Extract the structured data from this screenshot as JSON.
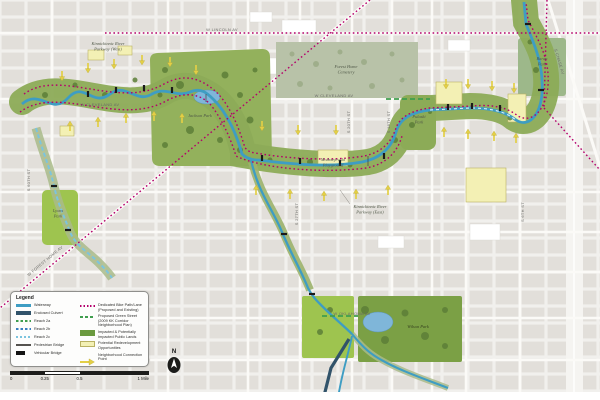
{
  "map": {
    "street_labels": [
      {
        "text": "W LINCOLN AV"
      },
      {
        "text": "W CLEVELAND AV"
      },
      {
        "text": "W CLEVELAND AV"
      },
      {
        "text": "W OKLAHOMA AV"
      },
      {
        "text": "W FOREST HOME AV"
      },
      {
        "text": "S CHASE AV"
      },
      {
        "text": "S 20TH ST"
      },
      {
        "text": "S 16TH ST"
      },
      {
        "text": "S 27TH ST"
      },
      {
        "text": "S 60TH ST"
      },
      {
        "text": "S 6TH ST"
      }
    ],
    "area_labels": [
      {
        "lines": [
          "Kinnickinnic River",
          "Parkway (West)"
        ]
      },
      {
        "lines": [
          "Jackson Park"
        ]
      },
      {
        "lines": [
          "Forest Home",
          "Cemetery"
        ]
      },
      {
        "lines": [
          "Kinnickinnic River",
          "Parkway (East)"
        ]
      },
      {
        "lines": [
          "Wilson Park"
        ]
      },
      {
        "lines": [
          "Lyons",
          "Park"
        ]
      },
      {
        "lines": [
          "Baran",
          "Park"
        ]
      },
      {
        "lines": [
          "Pulaski",
          "Park"
        ]
      },
      {
        "lines": [
          "Modrzejewski",
          "Playground"
        ]
      }
    ]
  },
  "legend": {
    "title": "Legend",
    "left_items": [
      {
        "label": "Waterway"
      },
      {
        "label": "Enclosed Culvert"
      },
      {
        "label": "Reach 2a"
      },
      {
        "label": "Reach 2b"
      },
      {
        "label": "Reach 2c"
      },
      {
        "label": "Pedestrian Bridge"
      },
      {
        "label": "Vehicular Bridge"
      }
    ],
    "right_items": [
      {
        "label": "Dedicated Bike Path/Lane (Proposed and Existing)"
      },
      {
        "label": "Proposed Green Street (2009 KK Corridor Neighborhood Plan)"
      },
      {
        "label": "Impacted & Potentially Impacted Public Lands"
      },
      {
        "label": "Potential Redevelopment Opportunities"
      },
      {
        "label": "Neighborhood Connection Point"
      }
    ]
  },
  "scale_bar": {
    "ticks": [
      "0",
      "0.25",
      "0.5",
      "1 Mile"
    ]
  },
  "north_arrow": {
    "label": "N"
  },
  "colors": {
    "waterway": "#3e9dc3",
    "enclosed_culvert": "#31536a",
    "reach_2a": "#3f9e4e",
    "reach_2b": "#3a7fc1",
    "reach_2c": "#7cc4de",
    "bike_path": "#b4006b",
    "green_street": "#3f9e4e",
    "greenway": "#8cab57",
    "impacted_lands": "#6b9a3f",
    "redevelopment": "#f3f0b4",
    "connection_arrow": "#e3cf46"
  }
}
